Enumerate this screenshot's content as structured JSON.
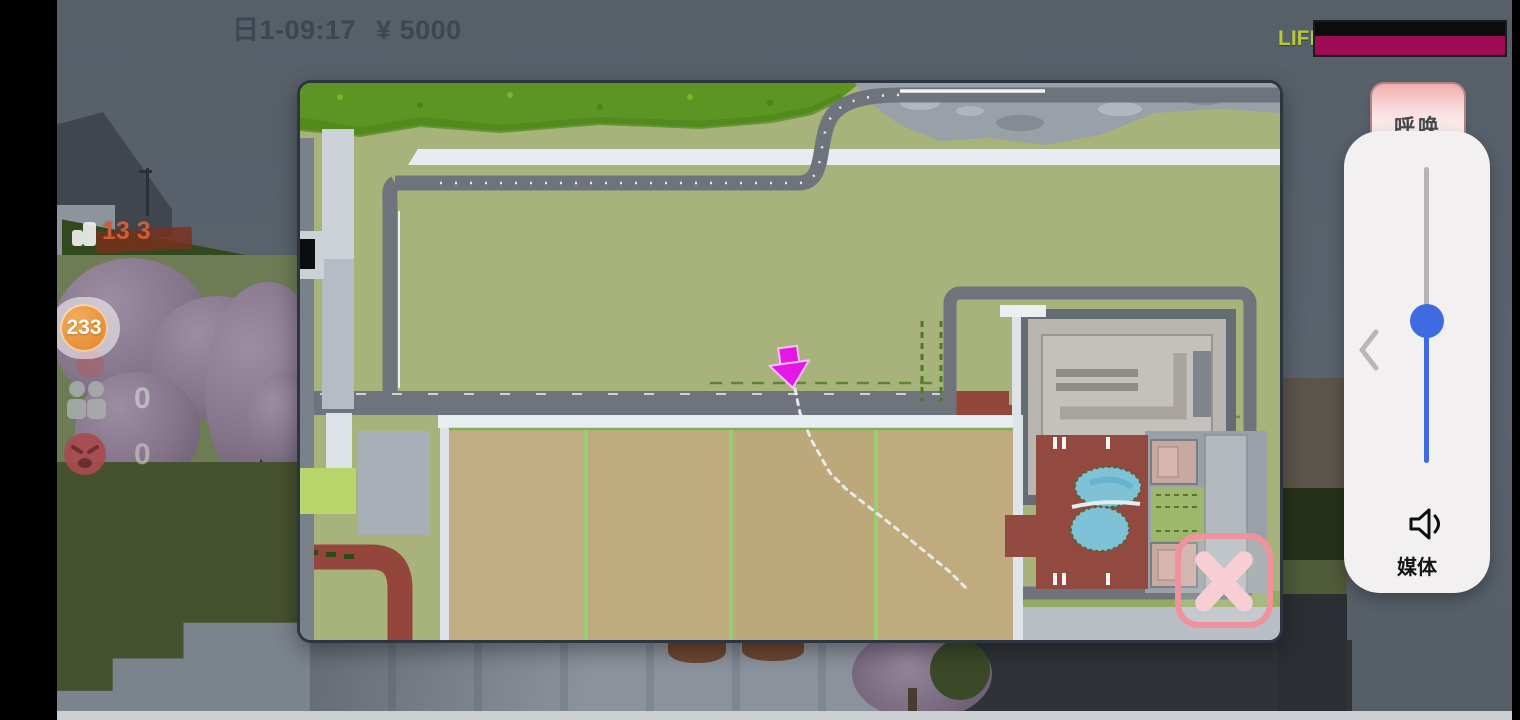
{
  "colors": {
    "life": "#9d0c54",
    "slider": "#3e6be0",
    "marker": "#e418e4",
    "close": "#f0919c",
    "badge": "#e2812a"
  },
  "status_bar": {
    "day_time": "日1-09:17",
    "money": "¥ 5000"
  },
  "life_meter": {
    "label": "LIFE",
    "value_fraction": 1
  },
  "left_hud": {
    "sign_text": "13 3",
    "badge_count": "233",
    "people_count": "0",
    "anger_count": "0"
  },
  "call_button": {
    "label": "呼唤"
  },
  "volume_panel": {
    "media_label": "媒体",
    "slider_level": 0.52
  },
  "minimap": {
    "marker_icon": "down-arrow-icon",
    "close_icon": "x-icon"
  }
}
